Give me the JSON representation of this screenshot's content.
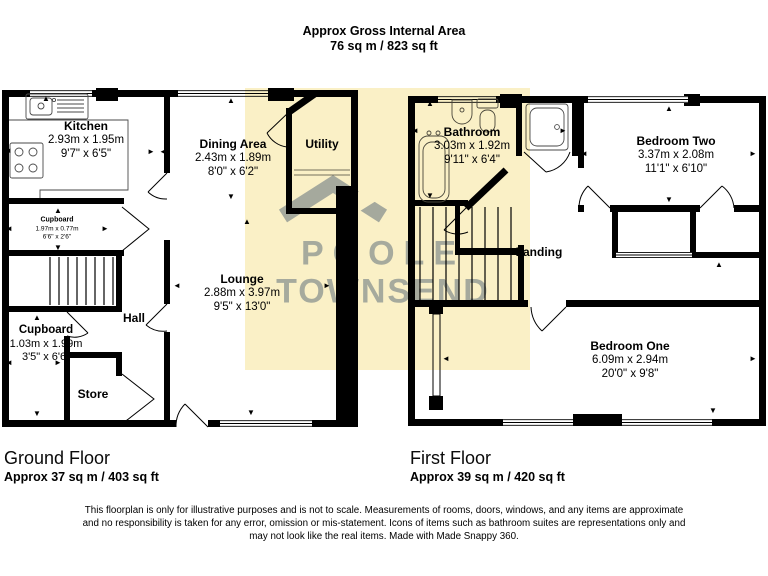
{
  "header": {
    "title": "Approx Gross Internal Area",
    "area": "76 sq m / 823 sq ft"
  },
  "watermark": {
    "line1": "POOLE",
    "line2": "TOWNSEND"
  },
  "colors": {
    "highlight": "#FAF0C6",
    "watermark_text": "rgba(162,175,198,0.92)",
    "wall": "#000000"
  },
  "floors": {
    "ground": {
      "name": "Ground Floor",
      "area": "Approx 37 sq m / 403 sq ft"
    },
    "first": {
      "name": "First Floor",
      "area": "Approx 39 sq m / 420 sq ft"
    }
  },
  "rooms": {
    "kitchen": {
      "name": "Kitchen",
      "metric": "2.93m x 1.95m",
      "imperial": "9'7\" x 6'5\""
    },
    "dining": {
      "name": "Dining Area",
      "metric": "2.43m x 1.89m",
      "imperial": "8'0\" x 6'2\""
    },
    "utility": {
      "name": "Utility"
    },
    "cupboard_small": {
      "name": "Cupboard",
      "metric": "1.97m x 0.77m",
      "imperial": "6'6\" x 2'6\""
    },
    "hall": {
      "name": "Hall"
    },
    "cupboard_large": {
      "name": "Cupboard",
      "metric": "1.03m x 1.99m",
      "imperial": "3'5\" x 6'6\""
    },
    "store": {
      "name": "Store"
    },
    "lounge": {
      "name": "Lounge",
      "metric": "2.88m x 3.97m",
      "imperial": "9'5\" x 13'0\""
    },
    "bathroom": {
      "name": "Bathroom",
      "metric": "3.03m x 1.92m",
      "imperial": "9'11\" x 6'4\""
    },
    "bedroom_two": {
      "name": "Bedroom Two",
      "metric": "3.37m x 2.08m",
      "imperial": "11'1\" x 6'10\""
    },
    "landing": {
      "name": "Landing"
    },
    "bedroom_one": {
      "name": "Bedroom One",
      "metric": "6.09m x 2.94m",
      "imperial": "20'0\" x 9'8\""
    }
  },
  "disclaimer": {
    "line1": "This floorplan is only for illustrative purposes and is not to scale. Measurements of rooms, doors, windows, and any items are approximate",
    "line2": "and no responsibility is taken for any error, omission or mis-statement. Icons of items such as bathroom suites are representations only and",
    "line3": "may not look like the real items. Made with Made Snappy 360."
  },
  "arrows": [
    {
      "g": "▲",
      "x": 46,
      "y": 99
    },
    {
      "g": "◄",
      "x": 8,
      "y": 151
    },
    {
      "g": "►",
      "x": 151,
      "y": 152
    },
    {
      "g": "◄",
      "x": 163,
      "y": 152
    },
    {
      "g": "▲",
      "x": 231,
      "y": 101
    },
    {
      "g": "▼",
      "x": 231,
      "y": 197
    },
    {
      "g": "▲",
      "x": 247,
      "y": 222
    },
    {
      "g": "◄",
      "x": 177,
      "y": 286
    },
    {
      "g": "►",
      "x": 327,
      "y": 286
    },
    {
      "g": "▼",
      "x": 251,
      "y": 413
    },
    {
      "g": "▲",
      "x": 58,
      "y": 211
    },
    {
      "g": "▼",
      "x": 58,
      "y": 248
    },
    {
      "g": "◄",
      "x": 9,
      "y": 229
    },
    {
      "g": "►",
      "x": 105,
      "y": 229
    },
    {
      "g": "▲",
      "x": 37,
      "y": 318
    },
    {
      "g": "▼",
      "x": 37,
      "y": 414
    },
    {
      "g": "◄",
      "x": 9,
      "y": 363
    },
    {
      "g": "►",
      "x": 58,
      "y": 363
    },
    {
      "g": "▲",
      "x": 430,
      "y": 104
    },
    {
      "g": "▼",
      "x": 430,
      "y": 196
    },
    {
      "g": "◄",
      "x": 415,
      "y": 131
    },
    {
      "g": "►",
      "x": 563,
      "y": 131
    },
    {
      "g": "▼",
      "x": 492,
      "y": 184
    },
    {
      "g": "▲",
      "x": 669,
      "y": 109
    },
    {
      "g": "▼",
      "x": 669,
      "y": 200
    },
    {
      "g": "◄",
      "x": 584,
      "y": 154
    },
    {
      "g": "►",
      "x": 753,
      "y": 154
    },
    {
      "g": "▲",
      "x": 719,
      "y": 265
    },
    {
      "g": "◄",
      "x": 446,
      "y": 359
    },
    {
      "g": "►",
      "x": 753,
      "y": 359
    },
    {
      "g": "▼",
      "x": 713,
      "y": 411
    }
  ]
}
